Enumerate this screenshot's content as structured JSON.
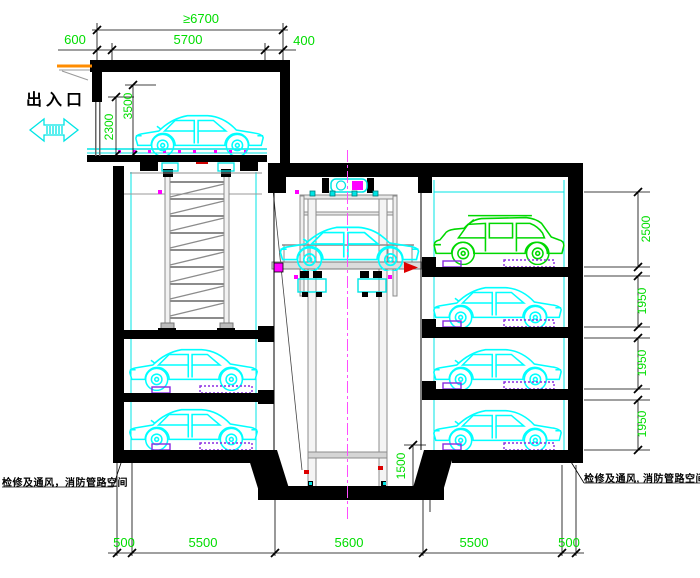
{
  "drawing": {
    "labels": {
      "entrance": "出入口",
      "left_note": "检修及通风，消防管路空间",
      "right_note": "检修及通风, 消防管路空间"
    },
    "dims": {
      "top_overall": "≥6700",
      "top_left": "600",
      "top_mid": "5700",
      "top_right": "400",
      "door_height": "2300",
      "clear_height": "3500",
      "levels": [
        "2500",
        "1950",
        "1950",
        "1950"
      ],
      "pit": "1500",
      "bottom": [
        "500",
        "5500",
        "5600",
        "5500",
        "500"
      ]
    },
    "icons": {
      "entrance_arrow": "double-headed-arrow"
    },
    "colors": {
      "wall": "#000000",
      "car_outline": "#00ffff",
      "suv_outline": "#00d800",
      "dimension_text": "#00dd00",
      "structure_gray": "#8c8c8c",
      "centerline": "#ff4dff",
      "pallet": "#8a2be2",
      "accent_magenta": "#ff00ff",
      "canopy": "#ff8c00"
    }
  }
}
